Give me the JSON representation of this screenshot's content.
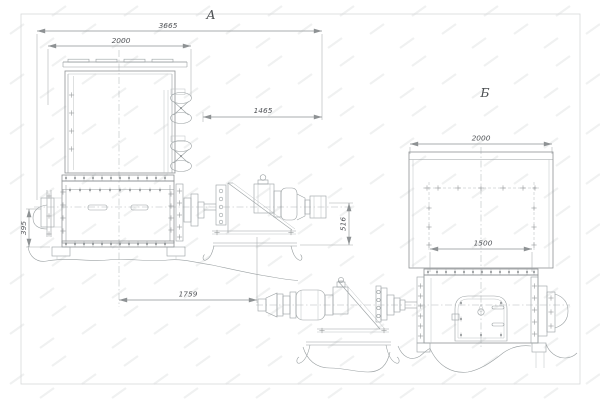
{
  "view_a": {
    "label": "А",
    "dims": {
      "overall_length": "3665",
      "hopper_width": "2000",
      "drive_length": "1465",
      "frame_length": "1759",
      "mount_height": "395",
      "drive_height": "516"
    }
  },
  "view_b": {
    "label": "Б",
    "dims": {
      "hopper_width": "2000",
      "body_width": "1500"
    }
  },
  "colors": {
    "line": "#8e9294",
    "line_light": "#bcc0c2",
    "line_dark": "#74787a",
    "text": "#53565a",
    "background": "#ffffff",
    "watermark": "#f0f1f1"
  }
}
